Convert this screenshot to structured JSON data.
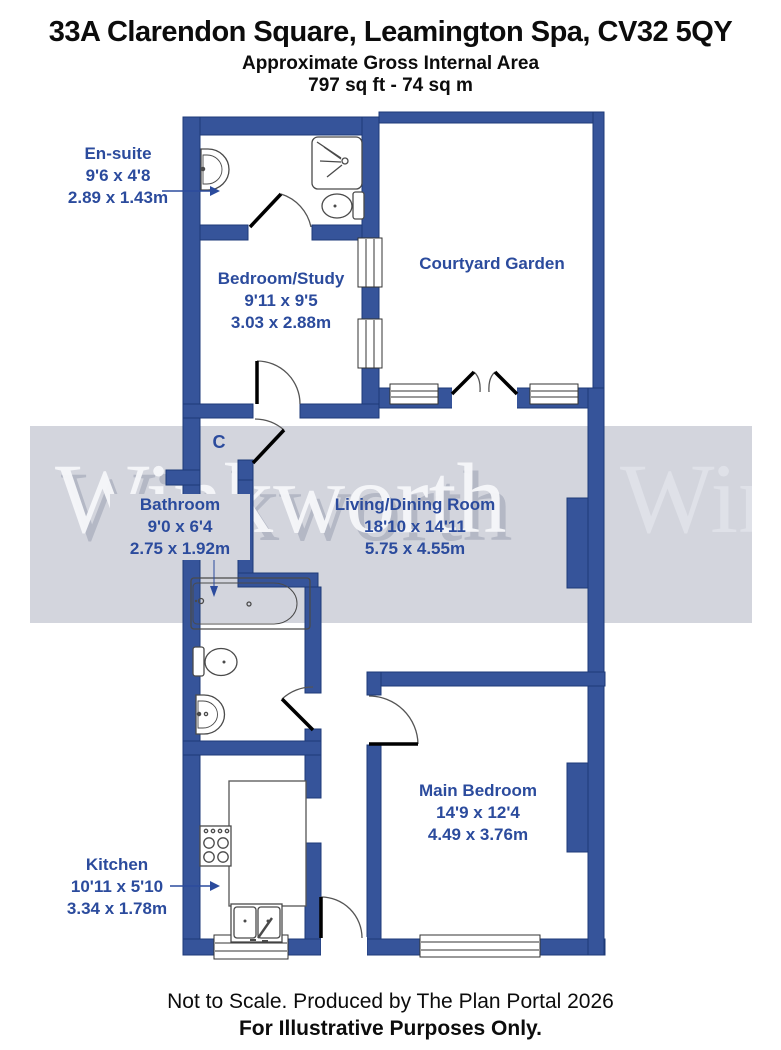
{
  "header": {
    "address": "33A Clarendon Square, Leamington Spa, CV32 5QY",
    "subtitle": "Approximate Gross Internal Area",
    "area": "797 sq ft - 74 sq m"
  },
  "watermark": {
    "text": "Winkworth",
    "band_color": "#d3d5dd",
    "text_color": "#f6f7fa"
  },
  "rooms": [
    {
      "id": "ensuite",
      "name": "En-suite",
      "imperial": "9'6 x 4'8",
      "metric": "2.89 x 1.43m"
    },
    {
      "id": "bedroom_study",
      "name": "Bedroom/Study",
      "imperial": "9'11 x 9'5",
      "metric": "3.03 x 2.88m"
    },
    {
      "id": "courtyard_garden",
      "name": "Courtyard Garden"
    },
    {
      "id": "bathroom",
      "name": "Bathroom",
      "imperial": "9'0 x 6'4",
      "metric": "2.75 x 1.92m"
    },
    {
      "id": "living_dining",
      "name": "Living/Dining Room",
      "imperial": "18'10 x 14'11",
      "metric": "5.75 x 4.55m"
    },
    {
      "id": "main_bedroom",
      "name": "Main Bedroom",
      "imperial": "14'9 x 12'4",
      "metric": "4.49 x 3.76m"
    },
    {
      "id": "kitchen",
      "name": "Kitchen",
      "imperial": "10'11 x 5'10",
      "metric": "3.34 x 1.78m"
    },
    {
      "id": "cupboard",
      "name": "C"
    }
  ],
  "footer": {
    "line1": "Not to Scale. Produced by The Plan Portal 2026",
    "line2": "For Illustrative Purposes Only."
  },
  "colors": {
    "wall_fill": "#36549a",
    "wall_stroke": "#1d3a78",
    "label_blue": "#2b4b9d",
    "door_leaf": "#000000",
    "fixture_stroke": "#4a4a4a"
  }
}
